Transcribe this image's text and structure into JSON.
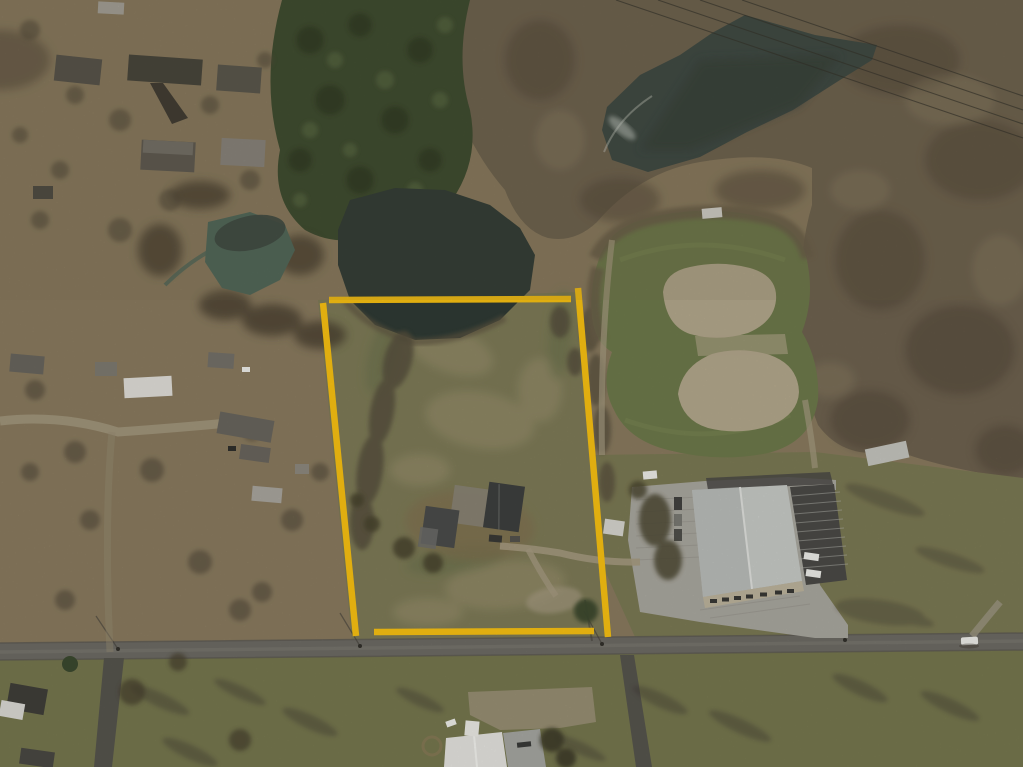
{
  "scene": {
    "type": "oblique-aerial-photograph",
    "season": "winter-bare-trees",
    "annotation": "yellow-property-boundary-outline",
    "landmarks": [
      "northwest-residential-neighborhood",
      "evergreen-grove",
      "creek-with-teal-pond",
      "large-dark-pond-northeast",
      "diagonal-power-lines",
      "subject-parcel-with-farmhouse-and-driveway",
      "two-baseball-infields-in-green-park",
      "white-roof-warehouse-with-parking-lots",
      "east-west-road-with-utility-poles",
      "church-building-south",
      "white-car-on-road-southeast"
    ]
  },
  "boundary": {
    "color": "#FBC312",
    "stroke_width": 6.5,
    "segments": [
      [
        323,
        303,
        356,
        636
      ],
      [
        329,
        300,
        571,
        299
      ],
      [
        578,
        288,
        608,
        637
      ],
      [
        374,
        632,
        594,
        631
      ]
    ]
  },
  "palette": {
    "base_terrain": "#8B7C60",
    "woods_brown": "#6F6350",
    "woods_dark": "#55493A",
    "evergreen": "#3B4A2E",
    "evergreen_dark": "#2C3A23",
    "pond_dark": "#3C4843",
    "pond_teal": "#50685B",
    "parcel_water": "#2F3B35",
    "parcel_grass": "#7F7C58",
    "parcel_grass_light": "#9B926F",
    "dirt_tan": "#83714F",
    "ballfield_grass": "#6E7A4B",
    "infield_sand": "#B5A98D",
    "grass_south": "#77784F",
    "grass_east": "#7C7A54",
    "road_asphalt": "#6E6C65",
    "road_dark": "#57554E",
    "driveway_light": "#A79C82",
    "concrete": "#ABA9A0",
    "asphalt_lot": "#4B4A47",
    "warehouse_roof": "#C9CCC8",
    "warehouse_roof_shade": "#B3B6B2",
    "warehouse_wall": "#BFB69E",
    "roof_dark": "#3E403F",
    "roof_gray": "#6A665E",
    "roof_white": "#E7E6E1",
    "shed_white": "#D8D7D1",
    "car_white": "#F0F0EB",
    "shadow": "#3E3930",
    "powerline": "#2F2E28",
    "water_foam": "#C8CFC9"
  }
}
